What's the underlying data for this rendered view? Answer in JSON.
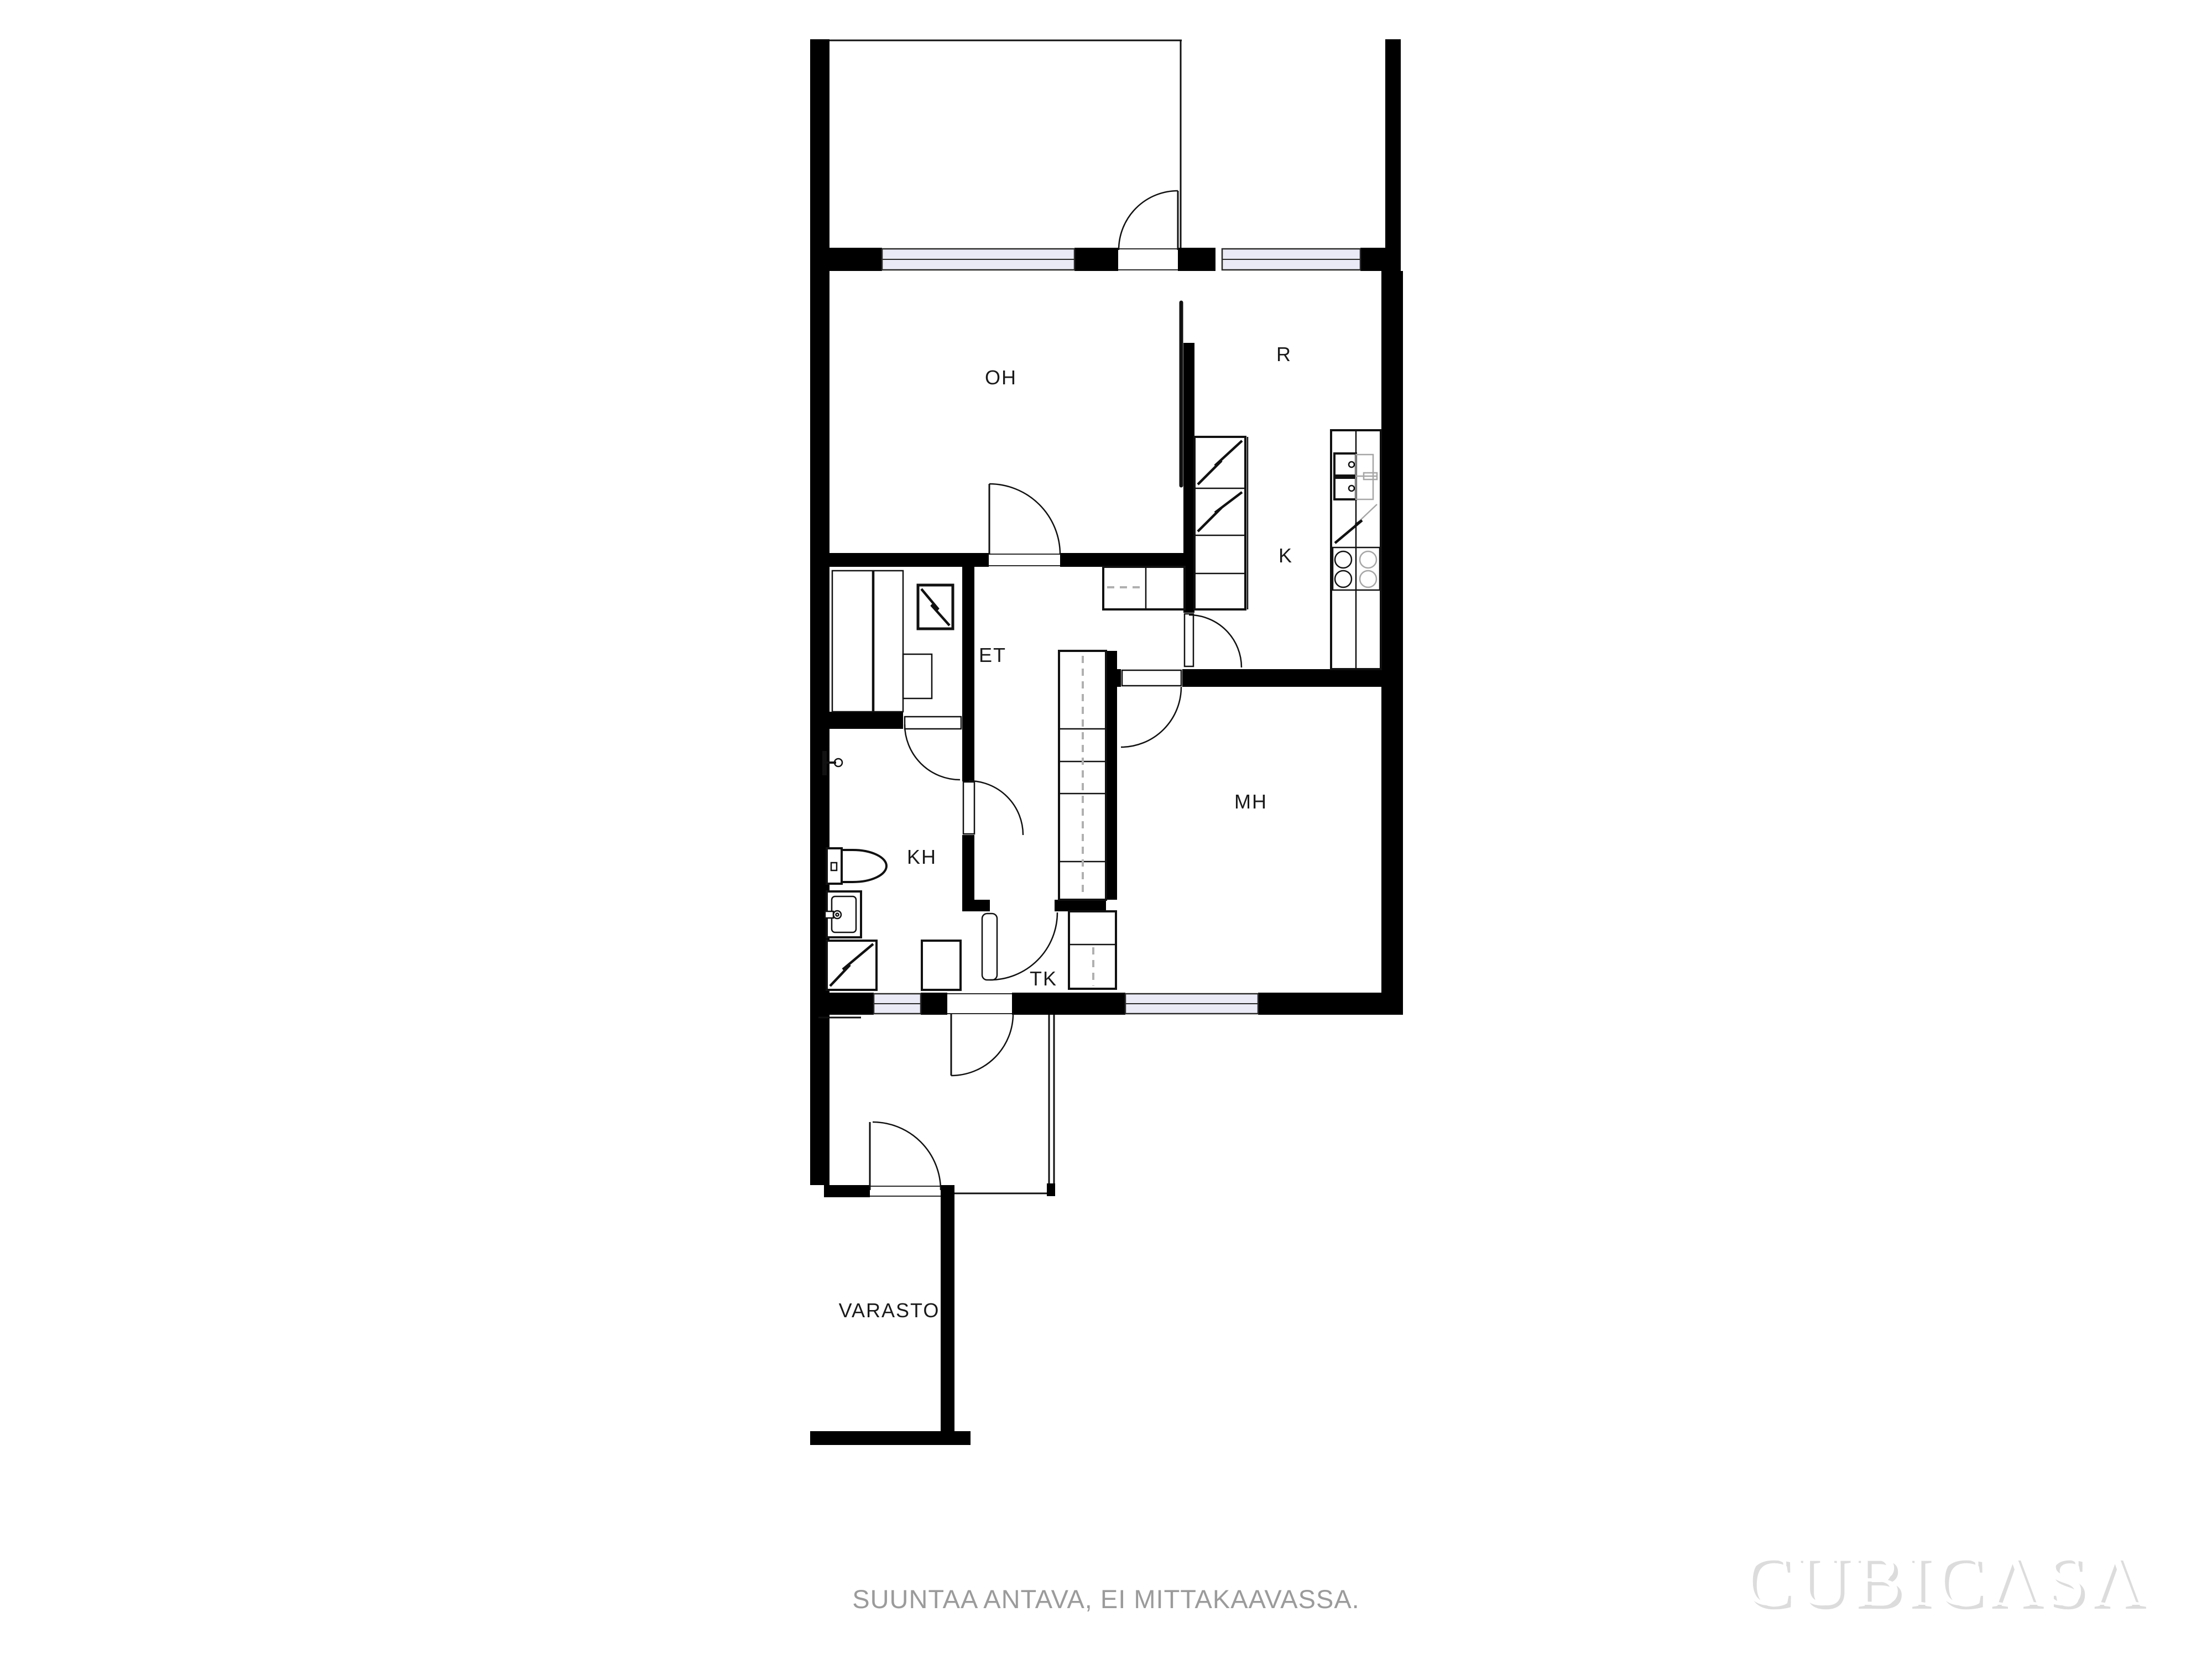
{
  "rooms": {
    "oh": "OH",
    "r": "R",
    "k": "K",
    "et": "ET",
    "kh": "KH",
    "mh": "MH",
    "tk": "TK",
    "varasto": "VARASTO"
  },
  "footer": {
    "disclaimer": "SUUNTAA ANTAVA, EI MITTAKAAVASSA."
  },
  "watermark": {
    "text": "CUBICΛSΛ"
  },
  "legend": {
    "window_symbol": "window-band",
    "door_symbol": "quarter-arc-door",
    "sauna_bench_symbol": "hatched-bench",
    "appliance_symbol": "zigzag-square"
  },
  "colors": {
    "wall": "#000000",
    "background": "#ffffff",
    "window_fill": "#eaeaf6",
    "symbol_gray": "#a6a6a6",
    "dashed_gray": "#b0b0b0",
    "disclaimer_text": "#9b9b9b",
    "watermark_shadow": "#dcdcdc",
    "watermark_fill": "#ffffff"
  }
}
